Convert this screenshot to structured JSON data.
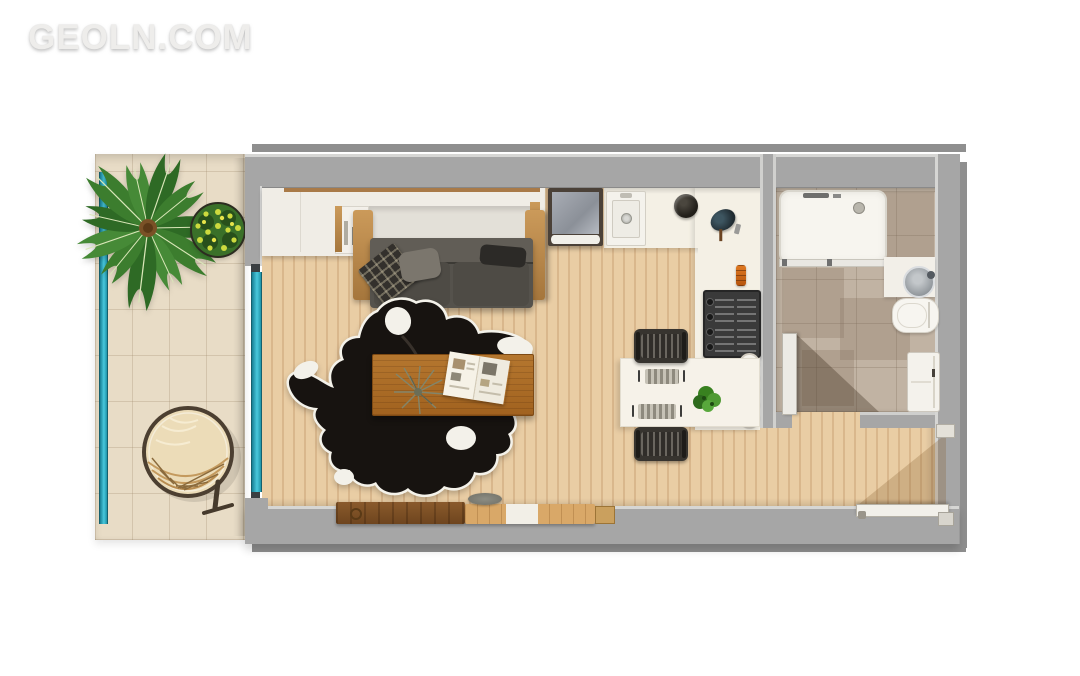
{
  "watermark": {
    "text": "GEOLN.COM"
  },
  "palette": {
    "wall": "#a6a6a6",
    "wall_dark": "#8f8f8f",
    "wood_floor": "#e4c59b",
    "balcony_tile": "#e8dcc6",
    "bathroom_tile": "#c1b3a3",
    "kitchen_floor": "#f4f0e5",
    "glass_teal": "#49c8dc",
    "sofa_gray": "#55524c",
    "rug_black": "#171310",
    "rug_white": "#f4f2ea",
    "table_wood": "#ab6b26",
    "plant_green": "#3c7d2e",
    "accent_orange": "#d96a1e"
  },
  "legend": {
    "rooms": [
      "balcony",
      "living-room",
      "kitchen",
      "bathroom",
      "entry-hall"
    ],
    "furniture": [
      "palm-plant",
      "flowering-bush",
      "hanging-chair",
      "glass-railing",
      "sliding-glass-door",
      "wardrobe",
      "sofa-bed",
      "cowhide-rug",
      "coffee-table",
      "magazine",
      "dried-plant",
      "sideboard",
      "fridge-unit",
      "kitchen-sink",
      "cooking-pot",
      "kettle",
      "spice-jar",
      "gas-cooktop",
      "plates",
      "dining-table",
      "dining-chair",
      "place-setting",
      "potted-plant",
      "shower",
      "washbasin",
      "toilet",
      "washing-machine",
      "bathroom-door",
      "entrance-door"
    ]
  }
}
